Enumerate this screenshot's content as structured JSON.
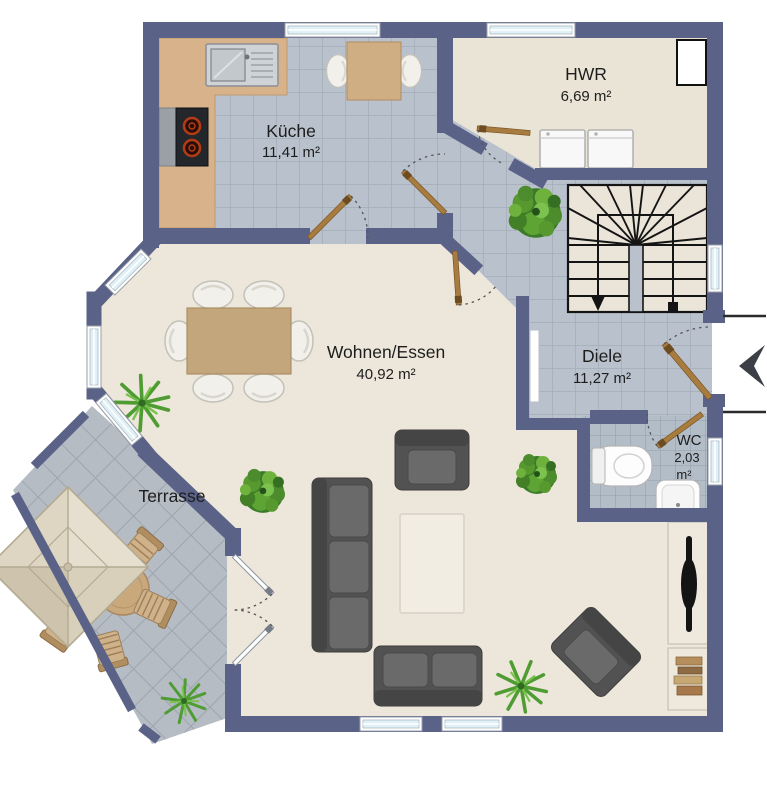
{
  "plan": {
    "title": "Erdgeschoss Grundriss",
    "rooms": [
      {
        "id": "kueche",
        "name": "Küche",
        "area": "11,41 m²"
      },
      {
        "id": "hwr",
        "name": "HWR",
        "area": "6,69 m²"
      },
      {
        "id": "wohnen_essen",
        "name": "Wohnen/Essen",
        "area": "40,92 m²"
      },
      {
        "id": "diele",
        "name": "Diele",
        "area": "11,27 m²"
      },
      {
        "id": "wc",
        "name": "WC",
        "area_value": "2,03",
        "area_unit": "m²"
      },
      {
        "id": "terrasse",
        "name": "Terrasse"
      }
    ],
    "icons": [
      "entrance-arrow-icon",
      "staircase",
      "parasol",
      "potted-plant",
      "palm-plant",
      "sofa",
      "armchair",
      "coffee-table",
      "dining-table",
      "tv-lowboard",
      "bookshelf",
      "washer",
      "dryer",
      "toilet",
      "hand-basin",
      "sink",
      "stove",
      "kitchen-counter"
    ],
    "colors": {
      "wall": "#5a6287",
      "tile_floor": "#b9c2cc",
      "tile_grout": "#a3adb8",
      "living_floor": "#ece7da",
      "hwr_floor": "#e9e4d6",
      "terrace_tile": "#b6bcc4",
      "counter_wood": "#d7b28a",
      "table_wood": "#c4a67c",
      "door_leaf": "#a87c3e",
      "window_glass": "#dff0f6",
      "sofa_gray": "#565656",
      "plant_green": "#4c8c2c",
      "stair_line": "#141414"
    }
  }
}
